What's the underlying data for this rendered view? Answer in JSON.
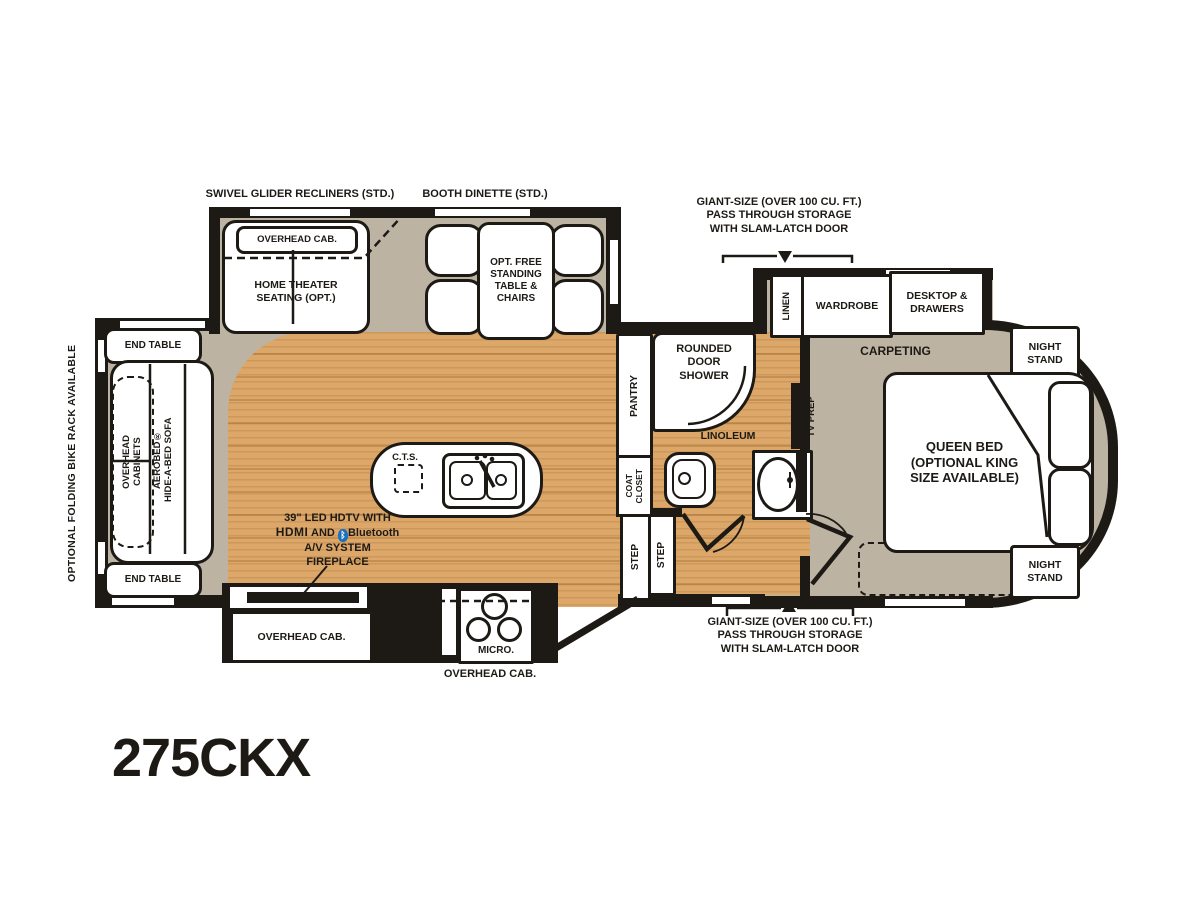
{
  "model": "275CKX",
  "colors": {
    "wood": "#DCA768",
    "wood_grain": "#B98A4B",
    "carpet": "#BDB3A3",
    "wall": "#1D1A16",
    "bluetooth_blue": "#1B6FC0"
  },
  "exterior": {
    "bike_rack": "OPTIONAL FOLDING BIKE RACK AVAILABLE",
    "storage_front_line1": "GIANT-SIZE (OVER 100 CU. FT.)",
    "storage_front_line2": "PASS THROUGH STORAGE",
    "storage_front_line3": "WITH SLAM-LATCH DOOR",
    "storage_rear_line1": "GIANT-SIZE (OVER 100 CU. FT.)",
    "storage_rear_line2": "PASS THROUGH STORAGE",
    "storage_rear_line3": "WITH SLAM-LATCH DOOR"
  },
  "living": {
    "slide_recliners_label": "SWIVEL GLIDER RECLINERS (STD.)",
    "slide_dinette_label": "BOOTH DINETTE (STD.)",
    "overhead_cab": "OVERHEAD CAB.",
    "home_theater_line1": "HOME THEATER",
    "home_theater_line2": "SEATING (OPT.)",
    "table_line1": "OPT. FREE",
    "table_line2": "STANDING",
    "table_line3": "TABLE &",
    "table_line4": "CHAIRS",
    "end_table_top": "END TABLE",
    "end_table_bottom": "END TABLE",
    "overhead_cabinets_line1": "OVERHEAD",
    "overhead_cabinets_line2": "CABINETS",
    "sofa_line1": "AEROBED®",
    "sofa_line2": "HIDE-A-BED SOFA",
    "tv_line1": "39\" LED HDTV WITH",
    "tv_hdmi": "HDMI",
    "tv_and": "AND",
    "tv_bluetooth": "Bluetooth",
    "tv_line2b": "A/V SYSTEM",
    "tv_line3": "FIREPLACE"
  },
  "kitchen": {
    "cts": "C.T.S.",
    "pantry": "PANTRY",
    "coat_line1": "COAT",
    "coat_line2": "CLOSET",
    "step_left": "STEP",
    "step_right": "STEP",
    "ent_overhead_cab": "OVERHEAD CAB.",
    "micro": "MICRO.",
    "overhead_cab_below": "OVERHEAD CAB."
  },
  "bath": {
    "shower_line1": "ROUNDED",
    "shower_line2": "DOOR",
    "shower_line3": "SHOWER",
    "linoleum": "LINOLEUM"
  },
  "bedroom": {
    "linen": "LINEN",
    "wardrobe": "WARDROBE",
    "desktop_line1": "DESKTOP &",
    "desktop_line2": "DRAWERS",
    "night_stand_line1": "NIGHT",
    "night_stand_line2": "STAND",
    "carpeting": "CARPETING",
    "tv_prep": "TV PREP",
    "bed_line1": "QUEEN BED",
    "bed_line2": "(OPTIONAL KING",
    "bed_line3": "SIZE AVAILABLE)"
  }
}
